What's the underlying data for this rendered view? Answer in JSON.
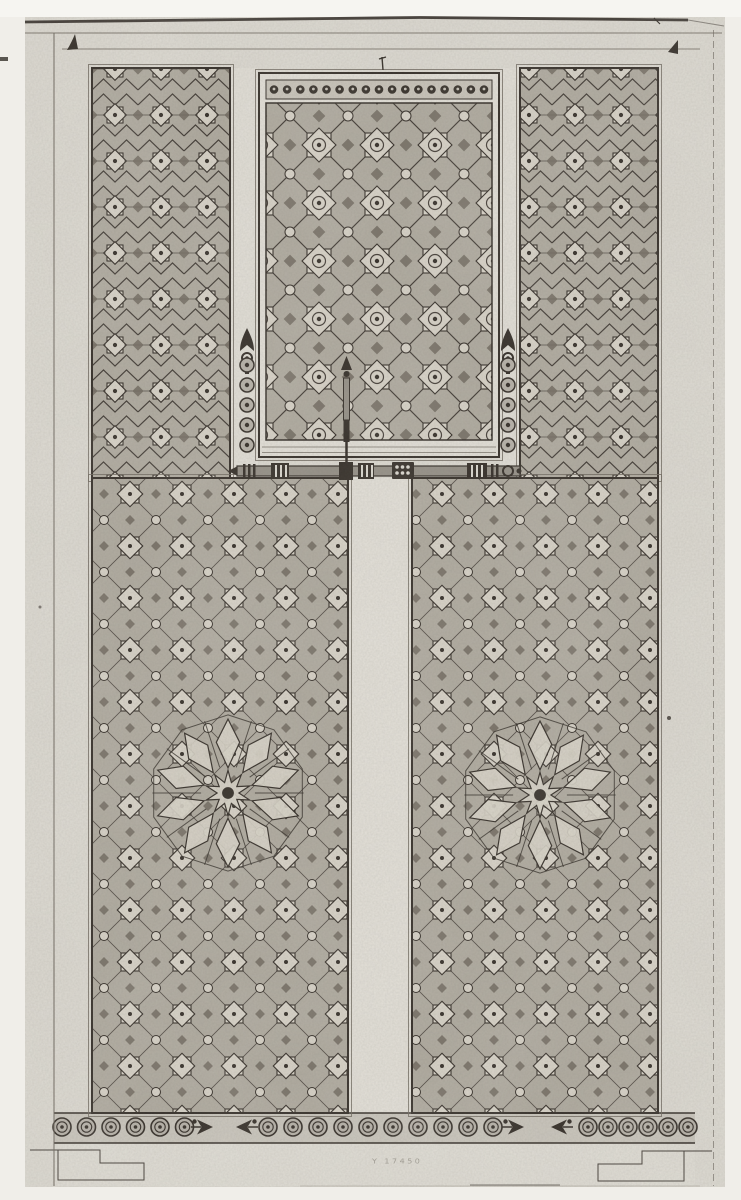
{
  "meta": {
    "description": "Scanned engraved plate: elevation of a carved wooden door with Moorish geometric star-pattern panels, nail heads and bolt hardware",
    "plate_mark": "Y 17450"
  },
  "colors": {
    "outer_paper": "#f0eee9",
    "plate": "#dbd8d0",
    "strip": "#e1ded6",
    "panel_base": "#afaa9f",
    "panel_raised": "#d6d1c6",
    "panel_accent": "#716a5f",
    "ink": "#352f29",
    "ink_mid": "#6f695f",
    "frieze_bg": "#c8c4bb",
    "bottom_band": "#dedbd3",
    "hardware": "#948f86",
    "dot_band": "#c7c2b8",
    "ring_fill": "#b6b1a8"
  },
  "ornament": {
    "center_panel_top_dots": {
      "count": 17,
      "y": 89.5,
      "x_start": 274,
      "x_end": 484
    },
    "nail_columns": [
      {
        "x": 247,
        "y_start": 365,
        "spacing": 20,
        "count": 5
      },
      {
        "x": 508,
        "y_start": 365,
        "spacing": 20,
        "count": 5
      }
    ],
    "frieze": {
      "y": 1127,
      "ring_runs": [
        {
          "x_start": 62,
          "spacing": 24.5,
          "count": 6
        },
        {
          "x_start": 268,
          "spacing": 25,
          "count": 10
        },
        {
          "x_start": 588,
          "spacing": 20,
          "count": 6
        }
      ],
      "arrows": [
        {
          "tip_x": 213,
          "dir": "right"
        },
        {
          "tip_x": 236,
          "dir": "left"
        },
        {
          "tip_x": 524,
          "dir": "right"
        },
        {
          "tip_x": 551,
          "dir": "left"
        }
      ]
    },
    "rosettes": [
      {
        "cx": 228,
        "cy": 793,
        "r": 84
      },
      {
        "cx": 540,
        "cy": 795,
        "r": 84
      }
    ]
  }
}
